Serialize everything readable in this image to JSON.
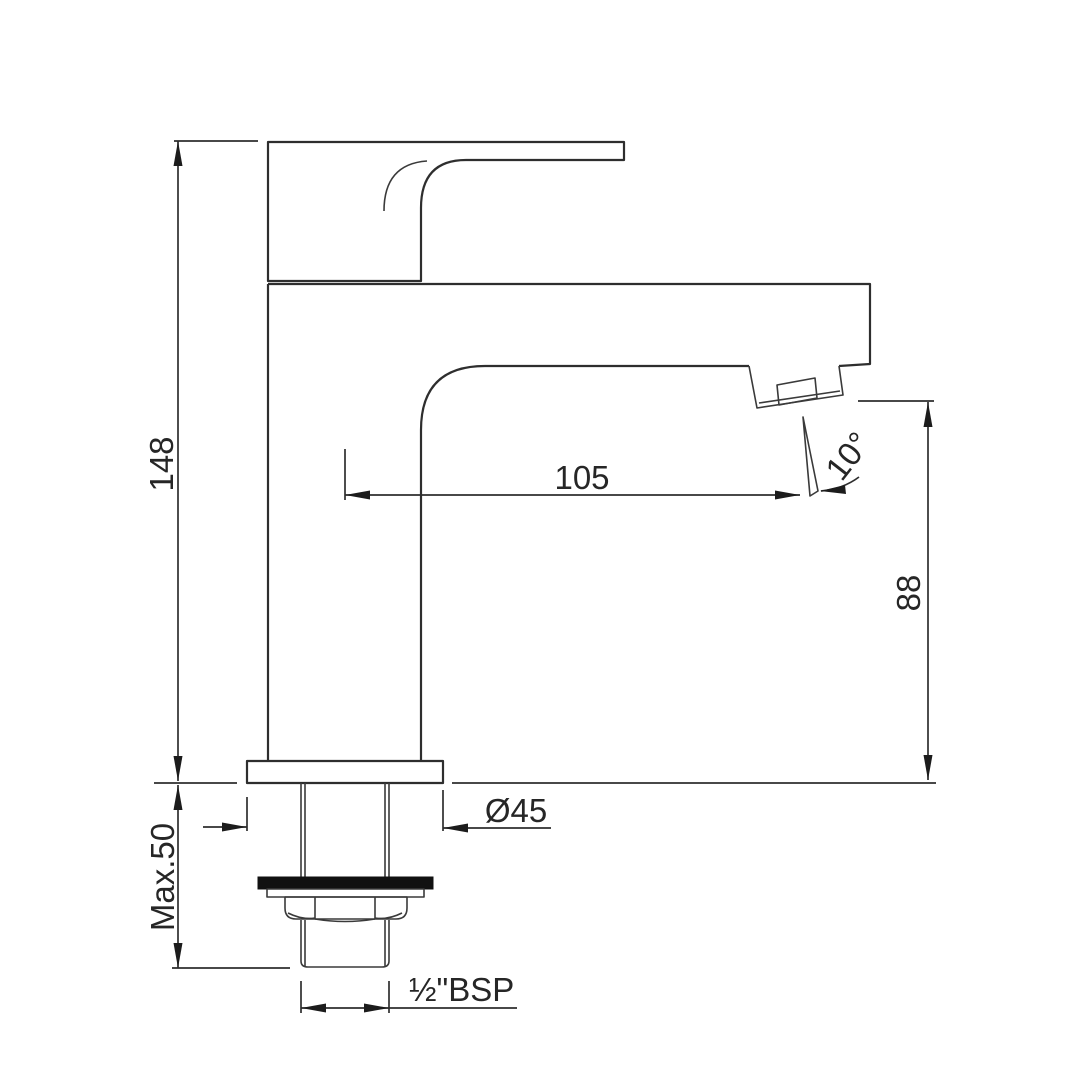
{
  "drawing": {
    "dimensions": {
      "overall_height": "148",
      "max_deck_thickness": "Max.50",
      "spout_reach": "105",
      "spout_angle": "10°",
      "spout_height": "88",
      "base_diameter": "Ø45",
      "inlet_thread": "½\"BSP"
    },
    "colors": {
      "line": "#2e2e2e",
      "background": "#ffffff",
      "washer": "#111111"
    }
  }
}
